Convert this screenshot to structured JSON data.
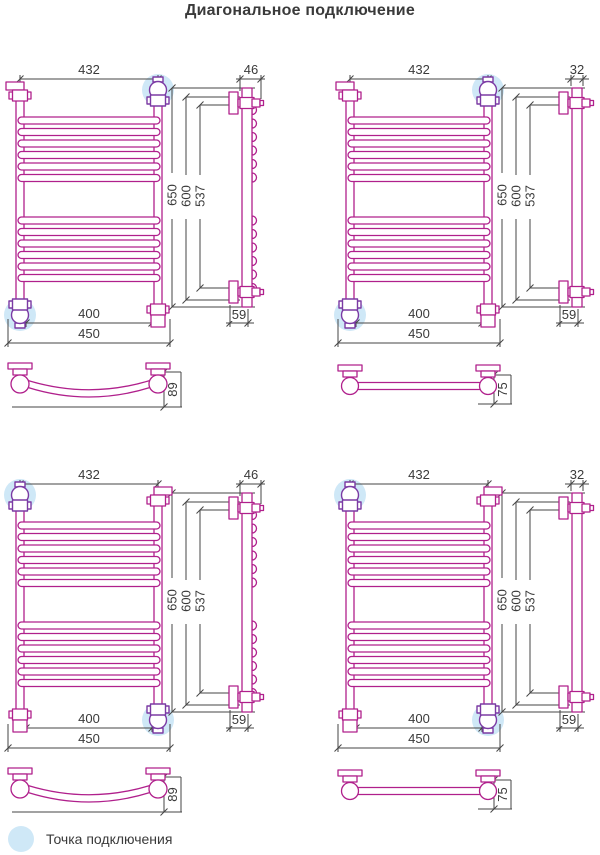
{
  "title": "Диагональное подключение",
  "legend": {
    "label": "Точка подключения"
  },
  "colors": {
    "pipe": "#b0208c",
    "fitting": "#7b3aa4",
    "highlight": "#cfe8f7",
    "dimension": "#454545",
    "text": "#3a3a3a"
  },
  "dimensions": {
    "top_width": "432",
    "overall_height": "650",
    "mount_height": "600",
    "rung_span_height": "537",
    "lower_width": "400",
    "overall_width": "450",
    "side_depth_curved": "46",
    "side_depth_flat": "32",
    "bottom_offset": "59",
    "profile_depth_curved": "89",
    "profile_depth_flat": "75"
  },
  "views": {
    "quadrants": [
      {
        "id": "top-left",
        "profile": "curved",
        "connection": "top-right-bottom-left"
      },
      {
        "id": "top-right",
        "profile": "flat",
        "connection": "top-right-bottom-left"
      },
      {
        "id": "bottom-left",
        "profile": "curved",
        "connection": "top-left-bottom-right"
      },
      {
        "id": "bottom-right",
        "profile": "flat",
        "connection": "top-left-bottom-right"
      }
    ]
  }
}
